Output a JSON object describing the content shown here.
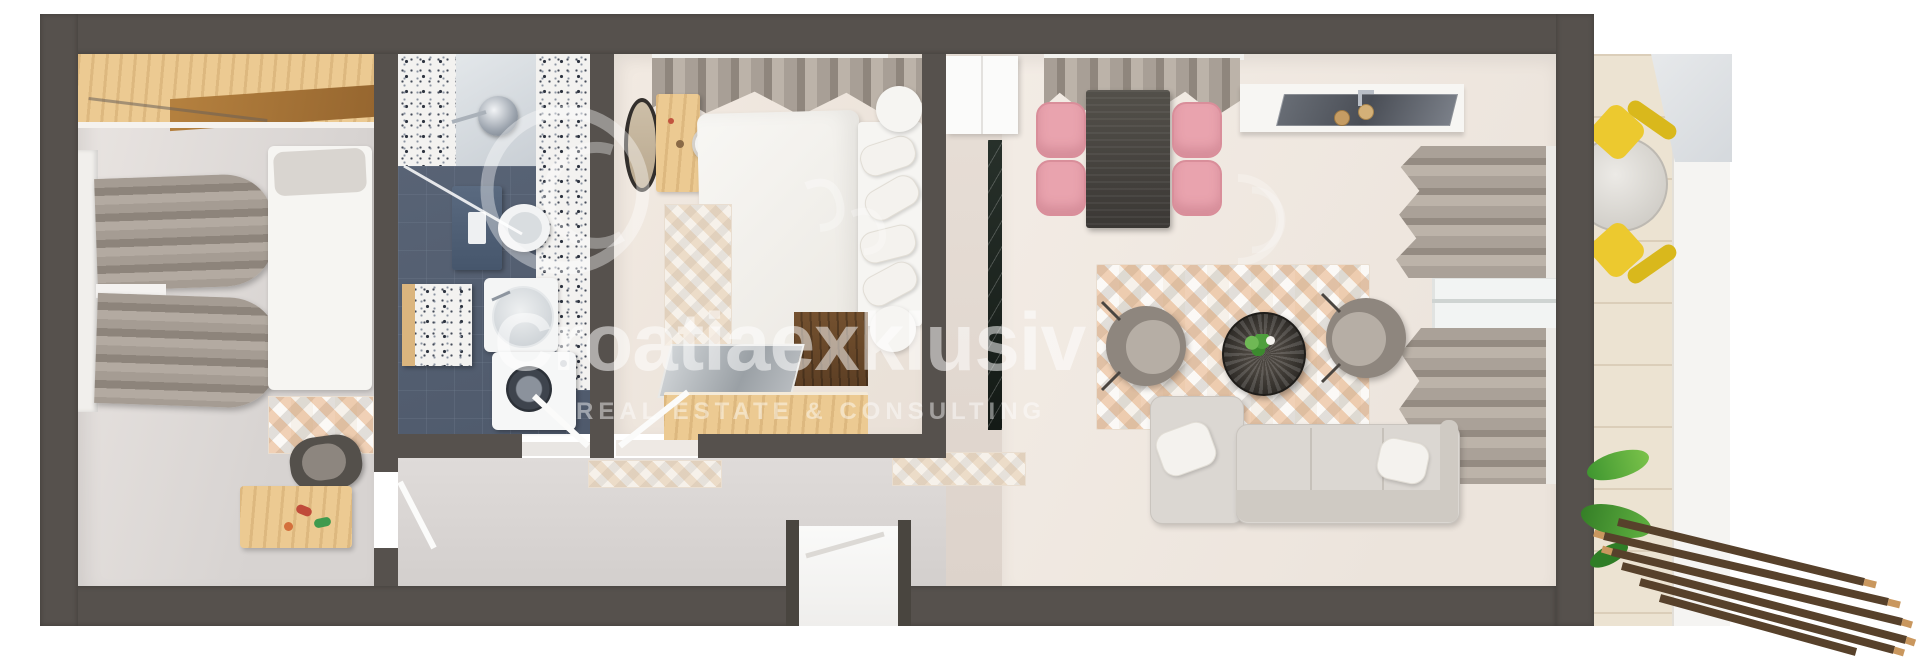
{
  "watermark": {
    "brand": "Croatiaexklusiv",
    "tagline": "REAL ESTATE & CONSULTING"
  },
  "palette": {
    "background": "#ffffff",
    "wall": "#56514d",
    "wall_dark": "#49453f",
    "bath_floor": "#5b6678",
    "wood_light": "#ecca92",
    "wood_mid": "#a97a40",
    "pink": "#e9a3ae",
    "yellow": "#ecc92f",
    "sofa": "#dbd7d2",
    "marble": "#1d241f",
    "plant": "#4f9f3d",
    "deck": "#57412b"
  },
  "scene": {
    "type": "3D top-down apartment floor plan rendering",
    "rooms": [
      "bedroom-left",
      "bathroom",
      "bedroom-middle",
      "hallway",
      "living-dining-kitchen",
      "entry-corridor",
      "balcony"
    ],
    "objects": [
      "wardrobe",
      "gray daybeds",
      "white bed",
      "storage chest",
      "pet bed",
      "walk-in shower",
      "wall-hung toilet",
      "round sink vanity",
      "washing machine",
      "double bed with platform headboard",
      "oval mirror",
      "dressing table with stool",
      "patterned triangle rugs",
      "dark dining table with four pink chairs",
      "kitchen counter with cooktop and sink",
      "two round armchairs",
      "round wire coffee table with plant",
      "corner sofa with pillows",
      "balcony round table with two yellow chairs",
      "potted plant",
      "wooden deck slats"
    ]
  }
}
